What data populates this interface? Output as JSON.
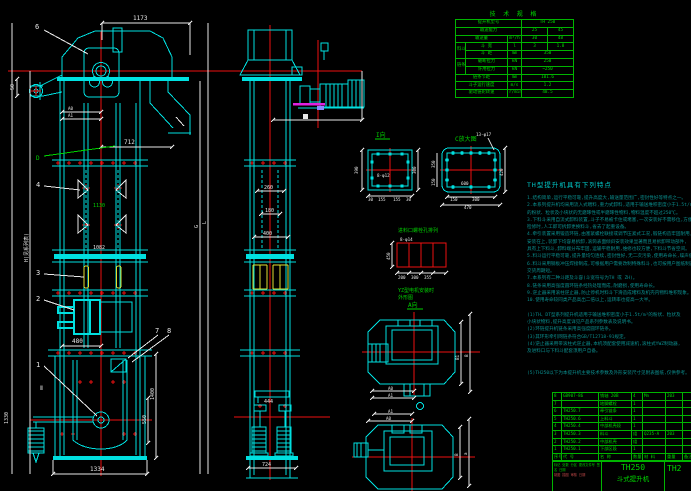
{
  "colors": {
    "cyan": "#00e0e0",
    "red": "#ee1111",
    "green": "#00d200",
    "yellow": "#e0e030",
    "magenta": "#e020e0",
    "notes_teal": "#0a8f8f",
    "black": "#000000"
  },
  "labels": {
    "front": {
      "d1173": "1173",
      "d712": "712",
      "d480": "480",
      "d1334": "1334",
      "d1400": "1400",
      "d550": "550",
      "d1330": "1330",
      "dH": "H(见系列表)",
      "a0": "A0",
      "a1": "A1",
      "g": "G",
      "l": "L",
      "d1130": "1130",
      "d1082": "1082",
      "d50": "50",
      "sec": "Ⅱ"
    },
    "balloons": {
      "n6": "6",
      "nD": "D",
      "n4": "4",
      "n3": "3",
      "n2": "2",
      "n1": "1",
      "n7": "7",
      "n8": "8"
    },
    "side": {
      "d260": "260",
      "d180": "180",
      "d400": "400",
      "d444": "444",
      "d724": "724"
    },
    "detail_i": {
      "title": "I向",
      "holes": "8-φ12",
      "d390": "390",
      "d300": "300",
      "t30a": "30",
      "t155a": "155",
      "t155b": "155",
      "t30b": "30"
    },
    "detail_c": {
      "title": "C放大图",
      "holes": "13-φ17",
      "d600": "600",
      "d150": "150",
      "d300": "300",
      "d470": "470",
      "d420": "420",
      "d350": "350",
      "d150b": "150"
    },
    "grid": {
      "title": "进料口螺栓孔排列",
      "holes": "8-φ14",
      "d450": "450",
      "d200": "200",
      "d300": "300",
      "d355": "355"
    },
    "plan_top": {
      "note1": "YZ型电机安装时",
      "note2": "外形图",
      "title": "A向",
      "b1": "B1",
      "b": "B",
      "a0": "A0",
      "a1": "A1"
    },
    "plan_bottom": {
      "a1": "A1",
      "a0": "A0",
      "b": "B",
      "a": "a"
    }
  },
  "spec_table": {
    "title": "技 术 规 格",
    "rows": {
      "model_label": "提升机型号",
      "model_value": "TH 250",
      "capacity_label": "输送能力",
      "cap_v1": "25",
      "cap_v2": "45",
      "volume_label": "输送量",
      "volume_unit": "m³/h",
      "vol_v1": "30",
      "vol_v2": "48",
      "bucket_group": "料斗",
      "width_label": "斗 宽",
      "width_unit": "l",
      "w_v1": "3",
      "w_v2": "1.8",
      "pitch_label": "斗 距",
      "pitch_unit": "mm",
      "pitch_value": "350",
      "chain_group": "链条",
      "break_label": "破断拉力",
      "break_unit": "kN",
      "break_value": "250",
      "allow_label": "许用拉力",
      "allow_unit": "kN",
      "allow_value": "~250",
      "link_label": "链条节距",
      "link_unit": "mm",
      "link_value": "101.6",
      "speed_label": "斗子运行速度",
      "speed_unit": "m/s",
      "speed_value": "1.2",
      "rpm_label": "驱动链轮转速",
      "rpm_unit": "r/min",
      "rpm_value": "48.5"
    }
  },
  "notes": {
    "heading": "TH型提升机具有下列特点",
    "lines": [
      "1.结构简单,运行平稳可靠,提升高度大,输送量范围广,密封性好等特点之一。",
      "2.本系列提升机均采用流入式喂料,重力式卸料,适用于输送堆积密度小于1.5t/m³",
      "   的粉状、粒状及小块状的无磨琢性或半磨琢性物料,物料温度不超过250℃。",
      "3.下料斗采用自流式卸料装置,斗子不易被卡住或堵塞,一次安装好不需移位,方便",
      "   检修时,人工即可拆卸更换料斗,省去了起重设备。",
      "4.牵引装置采用锻造环链,由塞紧螺栓联接或调节压紧式工况,锻链构造牢固耐用,",
      "   安装在上,装卸下均容易拆卸,滚筒表面倾斜安装效果显著而且易拆卸带动部件,",
      "   具有上下料斗,卸料端分布牢固,运输平稳耐用,维修也较方便,下料斗节省空间。",
      "5.料斗运行平稳可靠,提升量均匀连续,密封性好,无二次污染,使用寿命长,噪声低。",
      "6.料斗采用钢板冲压焊接制成,可根据用户需要改制特殊料斗,也可按用户图纸制造,",
      "   交货周期短。",
      "7.本系列有二种斗距及斗容(斗宽符号为TH 或 ZH)。",
      "8.链条采用高强度圆环链条经热处理而成,耐磨损,使用寿命长。",
      "9.逆止器采用滚柱逆止器,防止停机时料斗下滑造成堵料及机壳内物料堆积现象。",
      "10.使用寿命较同类产品高出二倍以上,运转率也提高一大半。",
      "",
      "(1)TH、DT型系列提升机适用于输送堆积密度小于1.5t/m³的粉状、粒状及",
      "   小块状物料,提升高度详见产品系列参数表及说明书。",
      "(2)环链提升机链条采用高强度圆环链条。",
      "(3)其环形牵引网链条符合GB/T12718-91规定。",
      "(4)逆止器采用带滚柱式逆止器,本机须配套使用减速机,滚柱式YWZ制动器,",
      "   及进料口与下料斗配套须用户自备。",
      "",
      "",
      "(5)TH250以下为本提升机主要技术参数及外形安装尺寸见附表图纸,仅供参考。"
    ]
  },
  "bom": {
    "rows": [
      [
        "8",
        "GB907-86",
        "销轴 20B",
        "4",
        "Mn",
        "203",
        ""
      ],
      [
        "7",
        "",
        "地脚螺栓",
        "1",
        "",
        "",
        ""
      ],
      [
        "6",
        "TH250.7",
        "牵引链条",
        "1",
        "",
        "",
        ""
      ],
      [
        "5",
        "TH250.6",
        "上料斗",
        "1",
        "",
        "",
        ""
      ],
      [
        "4",
        "TH250.4",
        "中部机壳段",
        "1",
        "",
        "",
        ""
      ],
      [
        "3",
        "TH250.3",
        "料斗",
        "组",
        "Q235-A",
        "203",
        ""
      ],
      [
        "2",
        "TH250.2",
        "中部机壳",
        "组",
        "",
        "",
        ""
      ],
      [
        "1",
        "TH250.1",
        "下部区段",
        "1",
        "",
        "",
        ""
      ]
    ],
    "footer": [
      "序号",
      "代 号",
      "名 称",
      "数量",
      "材 料",
      "重量",
      "备注"
    ]
  },
  "title_block": {
    "model": "TH250",
    "name": "斗式提升机",
    "right_partial": "TH2",
    "row1": "标记 处数 分区 更改文件号 签名 日期",
    "row2": "制图  描图  审核  日期"
  }
}
